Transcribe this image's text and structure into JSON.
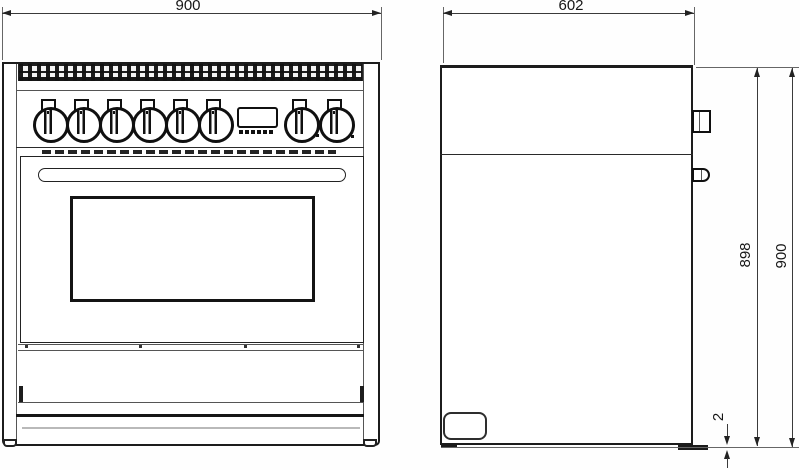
{
  "dimensions": {
    "front_width": "900",
    "side_depth": "602",
    "side_body_height": "898",
    "side_total_height": "900",
    "base_gap": "2"
  }
}
